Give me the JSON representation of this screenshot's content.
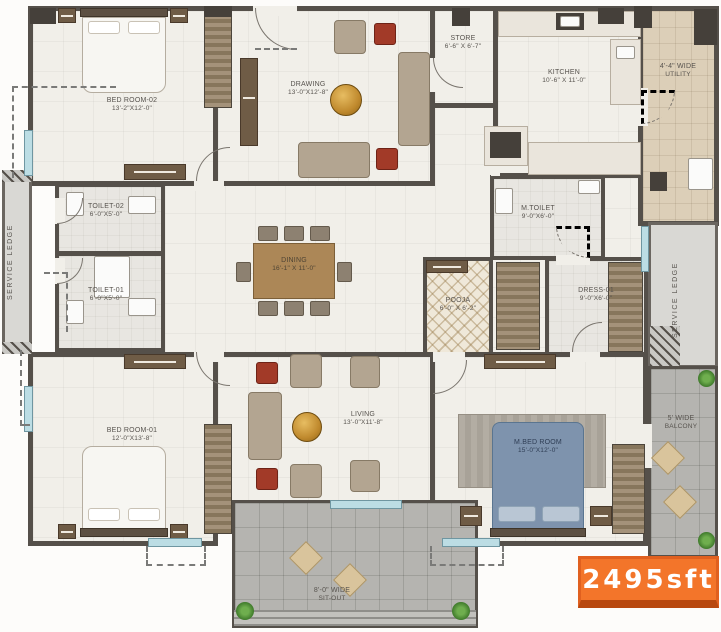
{
  "area_badge": "2495sft",
  "colors": {
    "badge_orange": "#f3752a",
    "wall": "#55504a",
    "window_blue": "#bcdde4"
  },
  "rooms": {
    "bedroom2": {
      "name": "BED ROOM-02",
      "dims": "13'-2\"X12'-0\""
    },
    "drawing": {
      "name": "DRAWING",
      "dims": "13'-0\"X12'-8\""
    },
    "store": {
      "name": "STORE",
      "dims": "6'-6\" X 6'-7\""
    },
    "kitchen": {
      "name": "KITCHEN",
      "dims": "10'-6\" X 11'-0\""
    },
    "utility": {
      "name": "4'-4\" WIDE",
      "dims": "UTILITY"
    },
    "toilet2": {
      "name": "TOILET-02",
      "dims": "6'-0\"X5'-0\""
    },
    "toilet1": {
      "name": "TOILET-01",
      "dims": "6'-0\"X5'-0\""
    },
    "service_ledge_left": {
      "name": "SERVICE LEDGE"
    },
    "dining": {
      "name": "DINING",
      "dims": "16'-1\" X 11'-0\""
    },
    "mtoilet": {
      "name": "M.TOILET",
      "dims": "9'-0\"X6'-0\""
    },
    "pooja": {
      "name": "POOJA",
      "dims": "6'-0\" X 6'-2\""
    },
    "dress1": {
      "name": "DRESS-01",
      "dims": "9'-0\"X6'-0\""
    },
    "service_ledge_right": {
      "name": "SERVICE LEDGE"
    },
    "bedroom1": {
      "name": "BED ROOM-01",
      "dims": "12'-0\"X13'-8\""
    },
    "living": {
      "name": "LIVING",
      "dims": "13'-0\"X11'-8\""
    },
    "mbedroom": {
      "name": "M.BED ROOM",
      "dims": "15'-0\"X12'-0\""
    },
    "balcony": {
      "name": "5' WIDE",
      "dims": "BALCONY"
    },
    "sitout": {
      "name": "8'-0\" WIDE",
      "dims": "SIT-OUT"
    }
  }
}
